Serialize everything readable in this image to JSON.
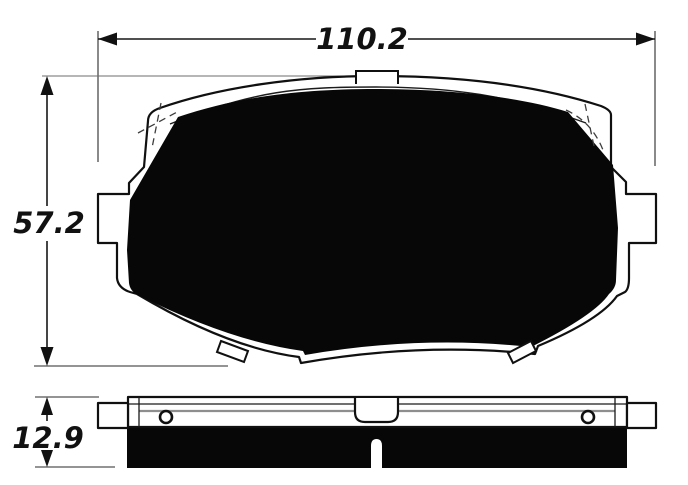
{
  "diagram": {
    "dimensions": {
      "width": {
        "label": "110.2"
      },
      "height": {
        "label": "57.2"
      },
      "thickness": {
        "label": "12.9"
      }
    },
    "colors": {
      "line": "#111111",
      "friction_fill": "#070707",
      "plate_fill": "#ffffff",
      "shim_line": "#8e8e8e",
      "background": "#ffffff"
    }
  }
}
